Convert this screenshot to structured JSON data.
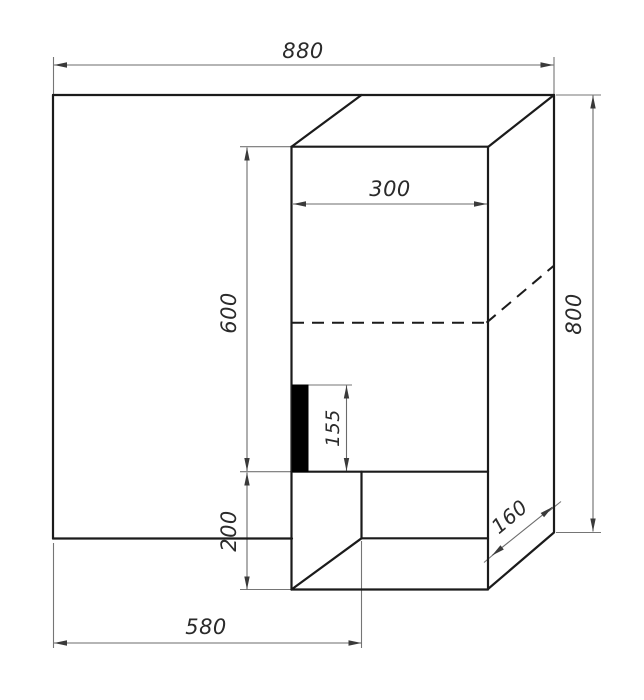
{
  "drawing": {
    "name": "furniture-corner-unit-technical-drawing",
    "background": "#ffffff",
    "colors": {
      "object_line": "#1b1b1b",
      "dimension_line": "#6b6b6b",
      "extension_line": "#757575",
      "arrow": "#3a3a3a",
      "text": "#2b2b2b",
      "panel_fill": "#000000"
    },
    "arrow": {
      "length": 13,
      "half_width": 2.7
    },
    "object_lines": [
      {
        "x1": 53,
        "y1": 95,
        "x2": 554,
        "y2": 95
      },
      {
        "x1": 53,
        "y1": 95,
        "x2": 53,
        "y2": 538.5
      },
      {
        "x1": 53,
        "y1": 538.5,
        "x2": 292,
        "y2": 538.5
      },
      {
        "x1": 554,
        "y1": 95,
        "x2": 554,
        "y2": 532
      },
      {
        "x1": 361.5,
        "y1": 95,
        "x2": 291.5,
        "y2": 146.7
      },
      {
        "x1": 554,
        "y1": 95,
        "x2": 488,
        "y2": 147
      },
      {
        "x1": 291.5,
        "y1": 146.7,
        "x2": 488,
        "y2": 146.7
      },
      {
        "x1": 291.5,
        "y1": 146.7,
        "x2": 291.5,
        "y2": 589.5
      },
      {
        "x1": 488,
        "y1": 147,
        "x2": 488,
        "y2": 589
      },
      {
        "x1": 291.5,
        "y1": 471.7,
        "x2": 488,
        "y2": 471.7
      },
      {
        "x1": 361.5,
        "y1": 538.3,
        "x2": 488,
        "y2": 538.3
      },
      {
        "x1": 361.5,
        "y1": 471.7,
        "x2": 361.5,
        "y2": 538.3
      },
      {
        "x1": 291.5,
        "y1": 589.5,
        "x2": 361.5,
        "y2": 538.3
      },
      {
        "x1": 291.5,
        "y1": 589.5,
        "x2": 488,
        "y2": 589.5
      },
      {
        "x1": 488,
        "y1": 589,
        "x2": 554,
        "y2": 532.5
      }
    ],
    "dashed_lines": [
      {
        "x1": 292,
        "y1": 322.7,
        "x2": 486.5,
        "y2": 322.7
      },
      {
        "x1": 486.5,
        "y1": 322.7,
        "x2": 553.5,
        "y2": 266
      }
    ],
    "black_panel": {
      "x": 292.5,
      "y": 385,
      "w": 15.5,
      "h": 86.5
    },
    "extension_lines": [
      {
        "x1": 53.5,
        "y1": 95,
        "x2": 53.5,
        "y2": 57
      },
      {
        "x1": 554,
        "y1": 95,
        "x2": 554,
        "y2": 57
      },
      {
        "x1": 556,
        "y1": 95,
        "x2": 601,
        "y2": 95
      },
      {
        "x1": 556,
        "y1": 532.5,
        "x2": 601,
        "y2": 532.5
      },
      {
        "x1": 240,
        "y1": 146.7,
        "x2": 291,
        "y2": 146.7
      },
      {
        "x1": 240,
        "y1": 471.7,
        "x2": 291,
        "y2": 471.7
      },
      {
        "x1": 240,
        "y1": 589.5,
        "x2": 291,
        "y2": 589.5
      },
      {
        "x1": 53.5,
        "y1": 543,
        "x2": 53.5,
        "y2": 648
      },
      {
        "x1": 361.5,
        "y1": 541,
        "x2": 361.5,
        "y2": 648
      },
      {
        "x1": 308,
        "y1": 385,
        "x2": 352,
        "y2": 385
      },
      {
        "x1": 484,
        "y1": 562.5,
        "x2": 497,
        "y2": 551.5
      },
      {
        "x1": 548.5,
        "y1": 511.5,
        "x2": 561,
        "y2": 501.5
      }
    ],
    "dimension_lines": [
      {
        "name": "dim-880",
        "x1": 54,
        "y1": 65,
        "x2": 553.5,
        "y2": 65
      },
      {
        "name": "dim-300",
        "x1": 293,
        "y1": 204,
        "x2": 487,
        "y2": 204
      },
      {
        "name": "dim-600",
        "x1": 247,
        "y1": 147.5,
        "x2": 247,
        "y2": 471
      },
      {
        "name": "dim-155",
        "x1": 346.5,
        "y1": 385.5,
        "x2": 346.5,
        "y2": 471
      },
      {
        "name": "dim-200",
        "x1": 247,
        "y1": 472.5,
        "x2": 247,
        "y2": 589.5
      },
      {
        "name": "dim-800",
        "x1": 593,
        "y1": 95.5,
        "x2": 593,
        "y2": 531.5
      },
      {
        "name": "dim-580",
        "x1": 54,
        "y1": 643,
        "x2": 361.5,
        "y2": 643
      },
      {
        "name": "dim-160",
        "x1": 492,
        "y1": 555.5,
        "x2": 552.5,
        "y2": 507
      }
    ],
    "labels": [
      {
        "text": "880",
        "x": 303,
        "y": 58,
        "rotate": 0,
        "size": 21
      },
      {
        "text": "300",
        "x": 390,
        "y": 196,
        "rotate": 0,
        "size": 21
      },
      {
        "text": "600",
        "x": 236,
        "y": 313,
        "rotate": -90,
        "size": 21
      },
      {
        "text": "155",
        "x": 339,
        "y": 428,
        "rotate": -90,
        "size": 19
      },
      {
        "text": "200",
        "x": 236,
        "y": 531,
        "rotate": -90,
        "size": 21
      },
      {
        "text": "800",
        "x": 581,
        "y": 314,
        "rotate": -90,
        "size": 21
      },
      {
        "text": "580",
        "x": 206,
        "y": 634,
        "rotate": 0,
        "size": 21
      },
      {
        "text": "160",
        "x": 514,
        "y": 522,
        "rotate": -40,
        "size": 20
      }
    ]
  }
}
